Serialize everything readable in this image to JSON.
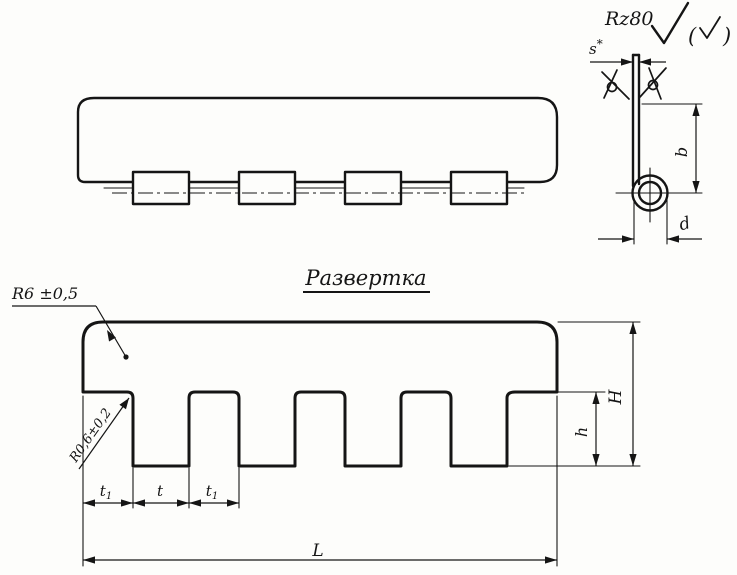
{
  "section_view": {
    "roughness_label": "Rz80",
    "paren_open": "(",
    "paren_close": ")",
    "dim_thickness": {
      "base": "s",
      "sup": "*"
    },
    "dim_curl_height": "b",
    "dim_curl_diameter": "d"
  },
  "flat_pattern": {
    "title": "Развертка",
    "dim_corner_radius": "R6 ±0,5",
    "dim_slot_radius": "R0,6±0,2",
    "dim_end_pitch": {
      "base": "t",
      "sub": "1"
    },
    "dim_tab_width": "t",
    "dim_length": "L",
    "dim_slot_depth": "h",
    "dim_total_height": "H"
  }
}
